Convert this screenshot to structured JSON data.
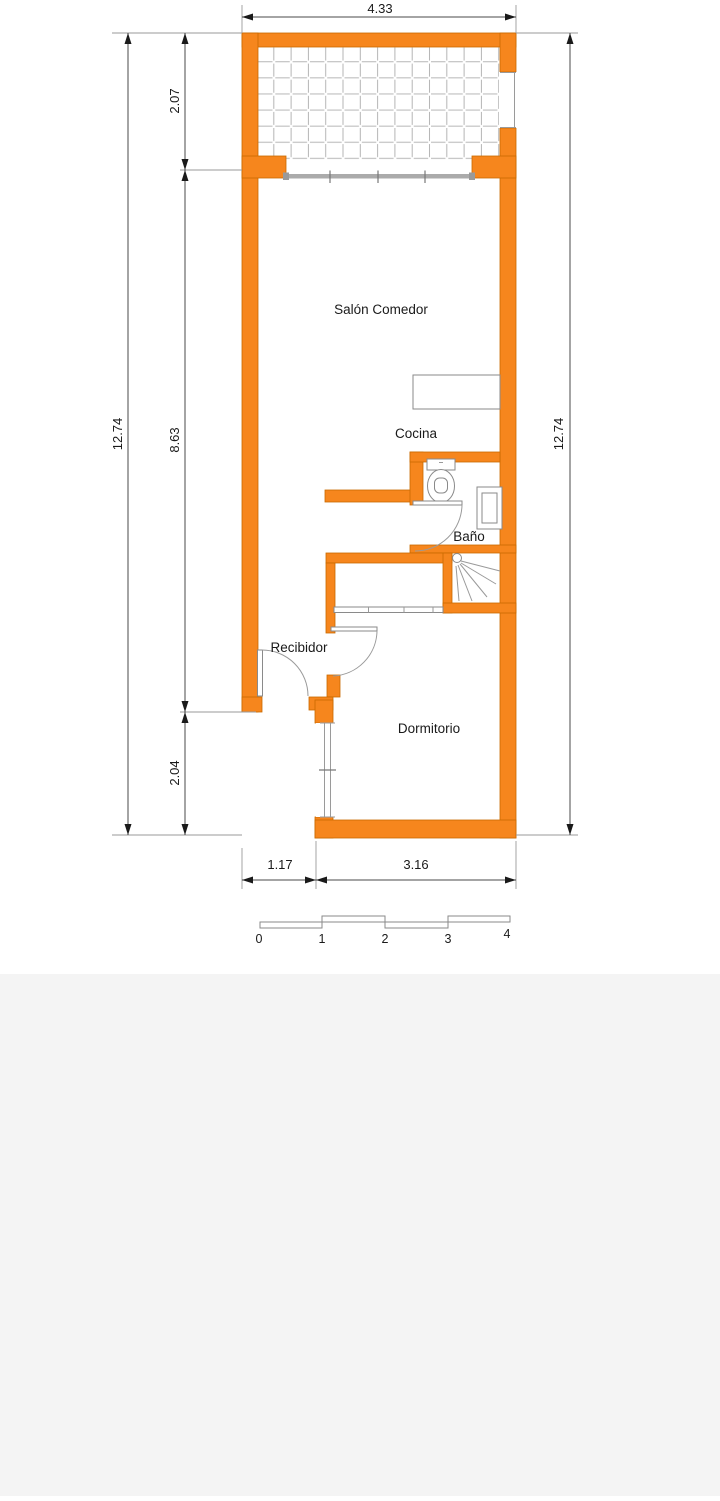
{
  "rooms": {
    "salon_comedor": "Salón Comedor",
    "cocina": "Cocina",
    "bano": "Baño",
    "recibidor": "Recibidor",
    "dormitorio": "Dormitorio"
  },
  "dimensions": {
    "width_top": "4.33",
    "height_left_total": "12.74",
    "height_right_total": "12.74",
    "terrace_depth": "2.07",
    "living_height": "8.63",
    "notch_height": "2.04",
    "bottom_left_width": "1.17",
    "bottom_right_width": "3.16"
  },
  "scale_bar": {
    "ticks": [
      "0",
      "1",
      "2",
      "3",
      "4"
    ]
  },
  "colors": {
    "wall": "#F6861D",
    "wall_outline": "#C96A00",
    "fixture_line": "#8a8a8a",
    "dimension_line": "#4a4a4a",
    "text": "#1a1a1a",
    "footer_background": "#f4f4f4"
  }
}
